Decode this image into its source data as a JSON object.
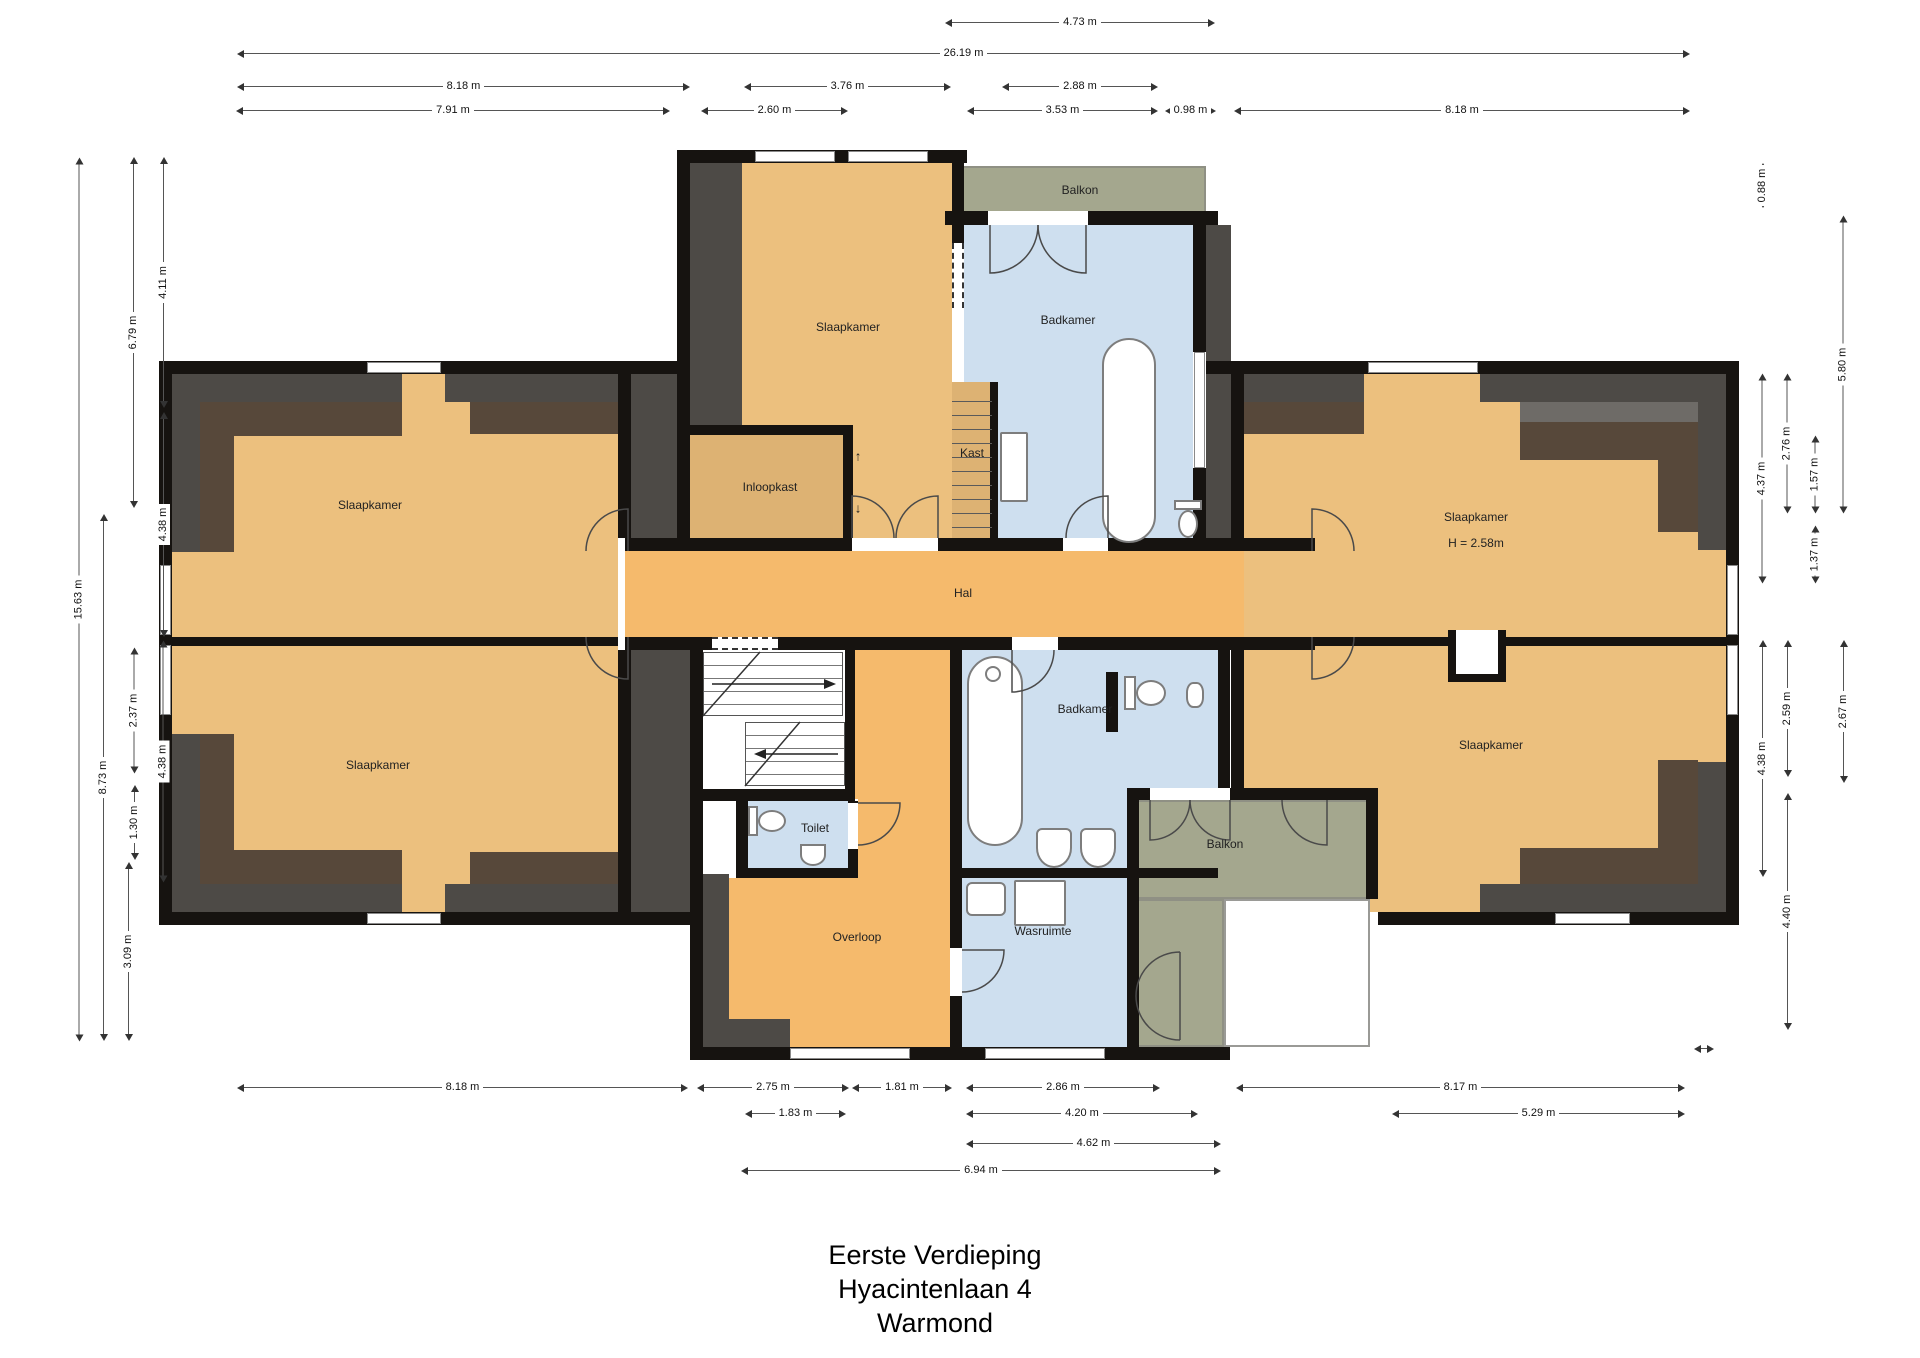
{
  "title": {
    "lines": [
      "Eerste Verdieping",
      "Hyacintenlaan 4",
      "Warmond"
    ]
  },
  "rooms": {
    "slaapkamer_top": "Slaapkamer",
    "badkamer_top": "Badkamer",
    "balkon_top": "Balkon",
    "inloopkast": "Inloopkast",
    "kast": "Kast",
    "hal": "Hal",
    "slaapkamer_left_upper": "Slaapkamer",
    "slaapkamer_left_lower": "Slaapkamer",
    "slaapkamer_right_upper": "Slaapkamer",
    "slaapkamer_right_upper_h": "H = 2.58m",
    "slaapkamer_right_lower": "Slaapkamer",
    "toilet": "Toilet",
    "overloop": "Overloop",
    "badkamer_lower": "Badkamer",
    "wasruimte": "Wasruimte",
    "balkon_lower": "Balkon"
  },
  "glyphs": {
    "arrow_up": "↑",
    "arrow_down": "↓"
  },
  "dimensions": {
    "top": [
      "4.73 m",
      "26.19 m",
      "8.18 m",
      "3.76 m",
      "2.88 m",
      "7.91 m",
      "2.60 m",
      "3.53 m",
      "0.98 m",
      "8.18 m"
    ],
    "left": [
      "4.11 m",
      "6.79 m",
      "4.38 m",
      "15.63 m",
      "2.37 m",
      "8.73 m",
      "4.38 m",
      "1.30 m",
      "3.09 m"
    ],
    "right": [
      "0.88 m",
      "5.80 m",
      "2.76 m",
      "4.37 m",
      "1.57 m",
      "1.37 m",
      "2.59 m",
      "4.38 m",
      "2.67 m",
      "4.40 m"
    ],
    "bottom": [
      "8.18 m",
      "2.75 m",
      "1.81 m",
      "2.86 m",
      "8.17 m",
      "1.83 m",
      "4.20 m",
      "5.29 m",
      "4.62 m",
      "6.94 m"
    ]
  },
  "colors": {
    "room_tan": "#ECC07E",
    "closet_tan": "#DDB273",
    "hall_orange": "#F5BA6C",
    "bath_blue": "#CEDFEF",
    "balcony_green": "#A4A78E",
    "roof_gray": "#4D4A46",
    "roof_brown": "#57483A",
    "wall_black": "#161310"
  }
}
